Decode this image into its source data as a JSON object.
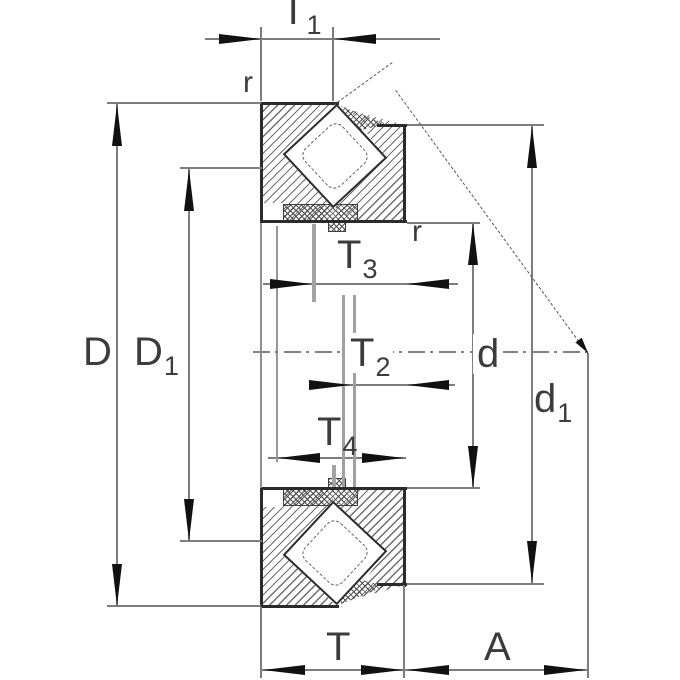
{
  "diagram": {
    "title": "bearing-cross-section-dimension-drawing",
    "colors": {
      "background": "#ffffff",
      "part_edge": "#2b2b2b",
      "dimension_line": "#7d7d7d",
      "arrow": "#111111",
      "hatch": "#6e6e6e",
      "label": "#3c3c3c"
    },
    "labels": {
      "T1": {
        "base": "T",
        "sub": "1"
      },
      "r_top": {
        "base": "r",
        "sub": ""
      },
      "r_bore": {
        "base": "r",
        "sub": ""
      },
      "D": {
        "base": "D",
        "sub": ""
      },
      "D1": {
        "base": "D",
        "sub": "1"
      },
      "T3": {
        "base": "T",
        "sub": "3"
      },
      "T2": {
        "base": "T",
        "sub": "2"
      },
      "T4": {
        "base": "T",
        "sub": "4"
      },
      "d": {
        "base": "d",
        "sub": ""
      },
      "d1": {
        "base": "d",
        "sub": "1"
      },
      "T": {
        "base": "T",
        "sub": ""
      },
      "A": {
        "base": "A",
        "sub": ""
      }
    }
  }
}
